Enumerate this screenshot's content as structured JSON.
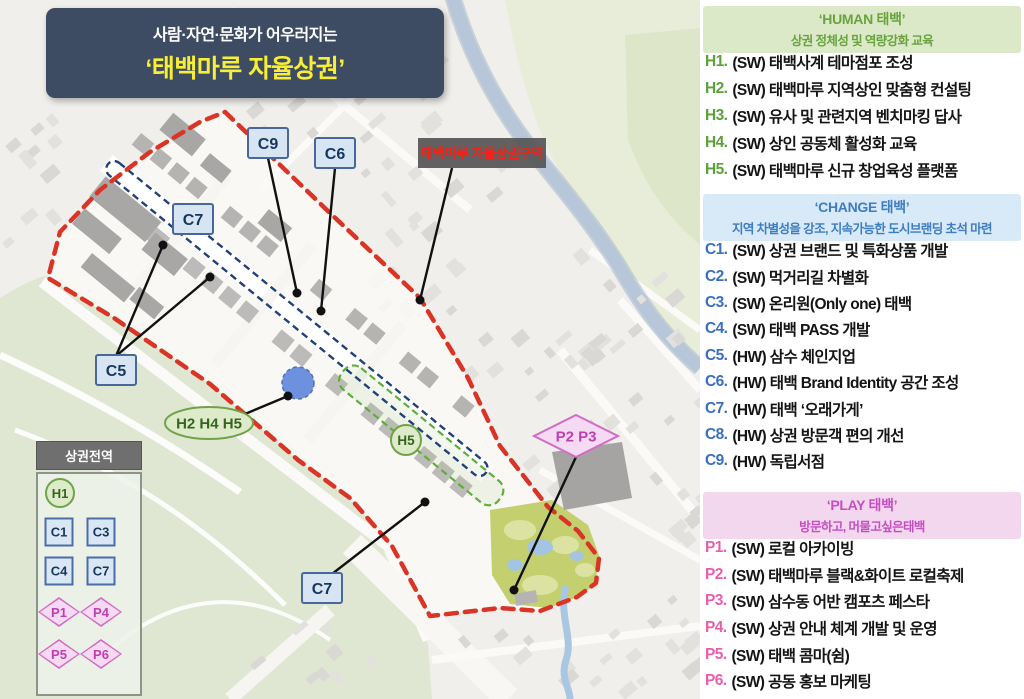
{
  "title": {
    "line1": "사람·자연·문화가 어우러지는",
    "line2": "‘태백마루 자율상권’"
  },
  "map": {
    "area_label": "태백마루 자율상권구역",
    "markers": {
      "c9": "C9",
      "c6": "C6",
      "c7_top": "C7",
      "c5": "C5",
      "c7_bottom": "C7",
      "h_group": "H2 H4 H5",
      "h5": "H5",
      "p_group": "P2 P3"
    },
    "legend": {
      "title": "상권전역",
      "circle": "H1",
      "squares": [
        "C1",
        "C3",
        "C4",
        "C7"
      ],
      "diamonds": [
        "P1",
        "P4",
        "P5",
        "P6"
      ]
    },
    "colors": {
      "district_boundary": "#d93425",
      "main_street_dashed": "#22407a",
      "sub_zone_dashed": "#60ad3d",
      "river": "#b7c6d9",
      "park": "#c4d06f",
      "marker_blue_fill": "#d7e5f3",
      "marker_blue_border": "#49679b",
      "marker_green_fill": "#ddebca",
      "marker_green_border": "#71a249",
      "marker_pink_fill": "#f6d9f2",
      "marker_pink_border": "#cf6cc3",
      "area_label_text": "#f32117"
    }
  },
  "panel": {
    "sections": [
      {
        "id": "human",
        "title": "‘HUMAN 태백’",
        "subtitle": "상권 정체성 및 역량강화 교육",
        "accent": "#69a33d",
        "header_bg": "#dbe9c9",
        "code_color": "#5ca03b",
        "items": [
          {
            "code": "H1.",
            "text": "(SW) 태백사계 테마점포 조성"
          },
          {
            "code": "H2.",
            "text": "(SW) 태백마루 지역상인 맞춤형 컨설팅"
          },
          {
            "code": "H3.",
            "text": "(SW) 유사 및 관련지역 벤치마킹 답사"
          },
          {
            "code": "H4.",
            "text": "(SW) 상인 공동체 활성화 교육"
          },
          {
            "code": "H5.",
            "text": "(SW) 태백마루 신규 창업육성 플랫폼"
          }
        ]
      },
      {
        "id": "change",
        "title": "‘CHANGE 태백’",
        "subtitle": "지역 차별성을 강조, 지속가능한 도시브랜딩 초석 마련",
        "accent": "#3d7dc1",
        "header_bg": "#d8e9f7",
        "code_color": "#3a6fc0",
        "items": [
          {
            "code": "C1.",
            "text": "(SW) 상권 브랜드 및 특화상품 개발"
          },
          {
            "code": "C2.",
            "text": "(SW) 먹거리길 차별화"
          },
          {
            "code": "C3.",
            "text": "(SW) 온리원(Only one) 태백"
          },
          {
            "code": "C4.",
            "text": "(SW) 태백 PASS 개발"
          },
          {
            "code": "C5.",
            "text": "(HW) 삼수 체인지업"
          },
          {
            "code": "C6.",
            "text": "(HW) 태백 Brand Identity 공간 조성"
          },
          {
            "code": "C7.",
            "text": "(HW) 태백 ‘오래가게’"
          },
          {
            "code": "C8.",
            "text": "(HW) 상권 방문객 편의 개선"
          },
          {
            "code": "C9.",
            "text": "(HW) 독립서점"
          }
        ]
      },
      {
        "id": "play",
        "title": "‘PLAY 태백’",
        "subtitle": "방문하고, 머물고싶은태백",
        "accent": "#c64ec0",
        "header_bg": "#f2d7ef",
        "code_color": "#e75fae",
        "items": [
          {
            "code": "P1.",
            "text": "(SW) 로컬 아카이빙"
          },
          {
            "code": "P2.",
            "text": "(SW) 태백마루 블랙&화이트 로컬축제"
          },
          {
            "code": "P3.",
            "text": "(SW) 삼수동 어반 캠포츠 페스타"
          },
          {
            "code": "P4.",
            "text": "(SW) 상권 안내 체계 개발 및 운영"
          },
          {
            "code": "P5.",
            "text": "(SW) 태백 콤마(쉼)"
          },
          {
            "code": "P6.",
            "text": "(SW) 공동 홍보 마케팅"
          }
        ]
      }
    ]
  }
}
